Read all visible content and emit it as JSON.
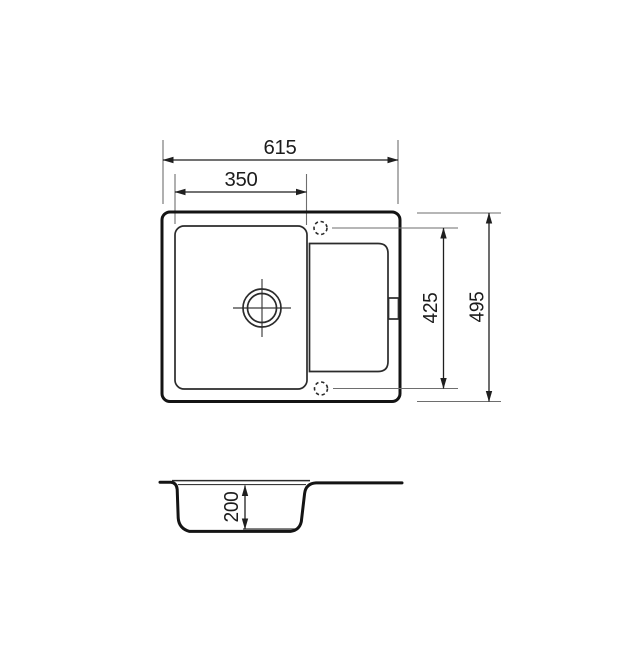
{
  "drawing": {
    "subject": "inset kitchen sink with single bowl and drainboard",
    "views": {
      "top": "plan view",
      "bottom": "bowl cross-section"
    }
  },
  "dimensions": {
    "overall_width": {
      "value": "615"
    },
    "bowl_width": {
      "value": "350"
    },
    "inner_length": {
      "value": "425"
    },
    "overall_depth": {
      "value": "495"
    },
    "bowl_depth": {
      "value": "200"
    }
  },
  "colors": {
    "line": "#141414",
    "mid_line": "#2b2b2b",
    "thin_line": "#3a3a3a",
    "dim_line": "#1f1f1f",
    "ext_line": "#6e6e6e",
    "text": "#1c1c1c",
    "bg": "#ffffff"
  }
}
